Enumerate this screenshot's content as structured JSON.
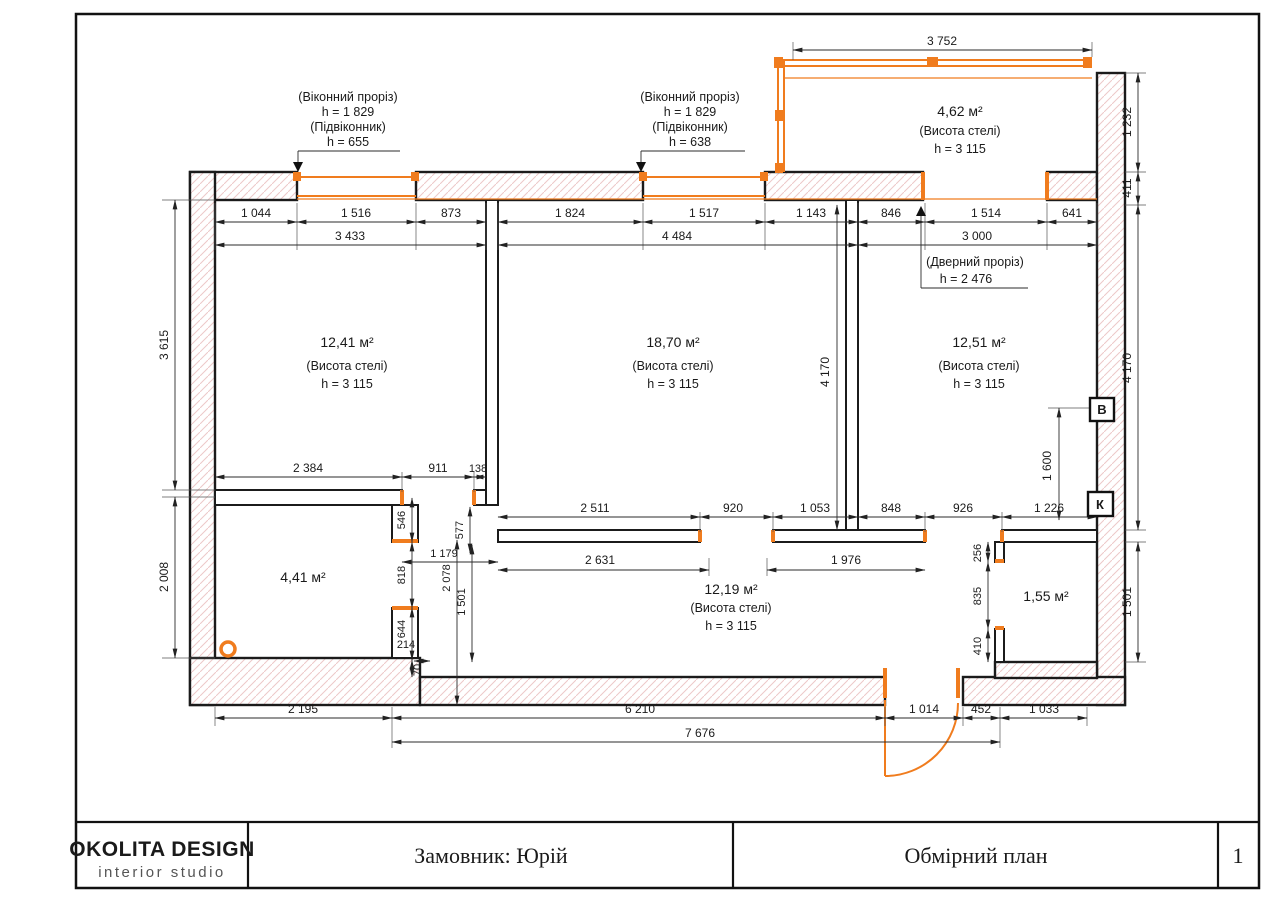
{
  "page": {
    "logo_line1": "OKOLITA DESIGN",
    "logo_line2": "interior studio",
    "client_label": "Замовник: Юрій",
    "sheet_title": "Обмірний план",
    "page_number": "1"
  },
  "colors": {
    "accent_orange": "#f07c1e",
    "hatch_red": "#edc9c9",
    "line": "#1b1b1b"
  },
  "rooms": {
    "r1": {
      "area": "12,41 м²",
      "note": "(Висота стелі)",
      "h": "h = 3 115"
    },
    "r2": {
      "area": "18,70 м²",
      "note": "(Висота стелі)",
      "h": "h = 3 115"
    },
    "r3": {
      "area": "12,51 м²",
      "note": "(Висота стелі)",
      "h": "h = 3 115"
    },
    "balcony": {
      "area": "4,62 м²",
      "note": "(Висота стелі)",
      "h": "h = 3 115"
    },
    "hall": {
      "area": "12,19 м²",
      "note": "(Висота стелі)",
      "h": "h = 3 115"
    },
    "r4": {
      "area": "4,41 м²"
    },
    "closet": {
      "area": "1,55 м²"
    }
  },
  "ann": {
    "win_left": [
      "(Віконний проріз)",
      "h = 1 829",
      "(Підвіконник)",
      "h = 655"
    ],
    "win_mid": [
      "(Віконний проріз)",
      "h = 1 829",
      "(Підвіконник)",
      "h = 638"
    ],
    "door": [
      "(Дверний проріз)",
      "h = 2 476"
    ]
  },
  "markers": {
    "v": "В",
    "k": "К"
  },
  "dims": {
    "bal_top": "3 752",
    "t1": "1 044",
    "t2": "1 516",
    "t3": "873",
    "t4": "3 433",
    "t5": "1 824",
    "t6": "1 517",
    "t7": "1 143",
    "t8": "4 484",
    "t9": "846",
    "t10": "1 514",
    "t11": "641",
    "t12": "3 000",
    "l1": "3 615",
    "l2": "2 008",
    "rr1": "1 232",
    "rr2": "411",
    "rr3": "4 170",
    "rr4": "1 501",
    "mv": "4 170",
    "v16": "1 600",
    "rb1": "2 384",
    "rb2": "911",
    "rb3": "138",
    "c546": "546",
    "c577": "577",
    "c1179": "1 179",
    "c818": "818",
    "c2078": "2 078",
    "c1501": "1 501",
    "c644": "644",
    "c214": "214",
    "c70": "70",
    "m1": "2 511",
    "m2": "920",
    "m3": "1 053",
    "m4": "848",
    "m5": "926",
    "m6": "1 226",
    "h1": "2 631",
    "h2": "1 976",
    "k1": "256",
    "k2": "835",
    "k3": "410",
    "b1": "2 195",
    "b2": "6 210",
    "b3": "1 014",
    "b4": "452",
    "b5": "1 033",
    "b6": "7 676"
  }
}
